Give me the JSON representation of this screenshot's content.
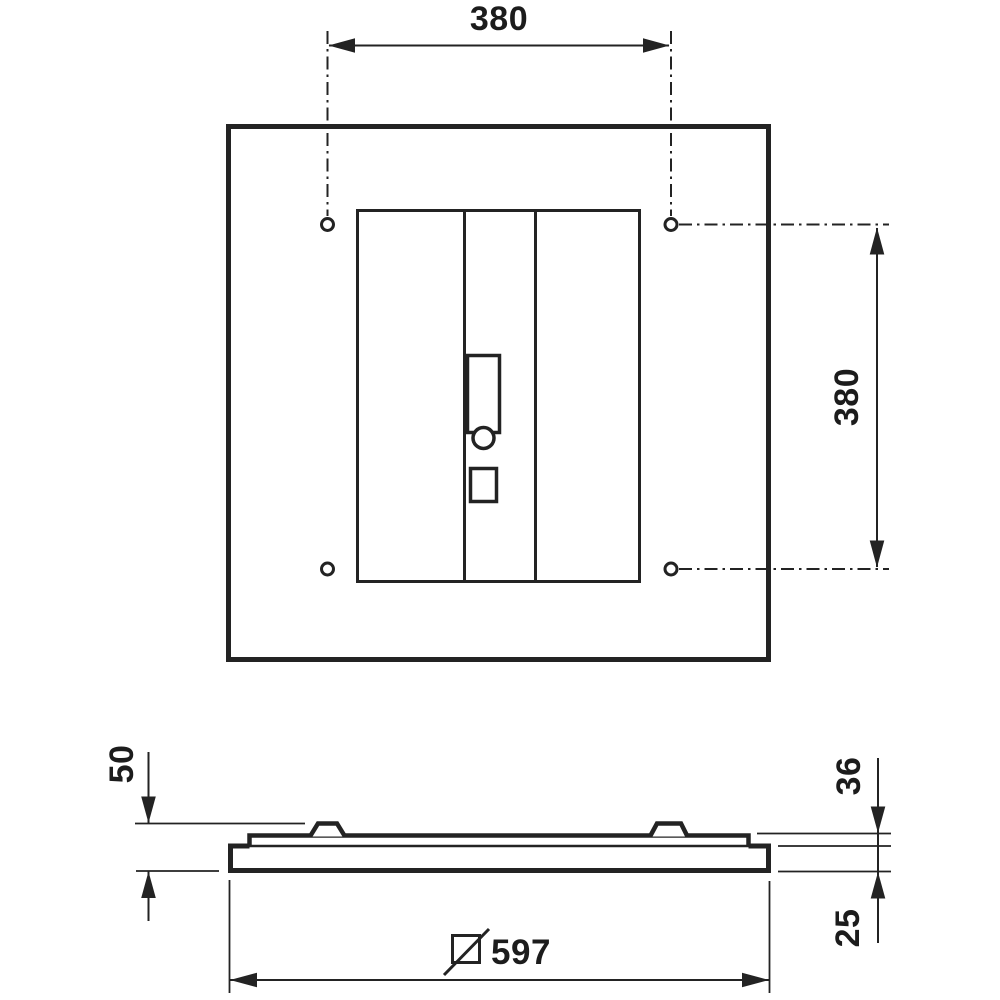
{
  "page": {
    "background": "#ffffff",
    "ink": "#232323"
  },
  "drawing": {
    "kind": "technical-dimension-drawing",
    "views": {
      "top": {
        "name": "top-view",
        "dims": {
          "hole_spacing_x": "380",
          "hole_spacing_y": "380"
        }
      },
      "side": {
        "name": "side-profile-view",
        "dims": {
          "total_height": "50",
          "upper_height": "36",
          "lower_height": "25",
          "width": "597"
        },
        "width_symbol": "slashed-square-icon"
      }
    }
  }
}
